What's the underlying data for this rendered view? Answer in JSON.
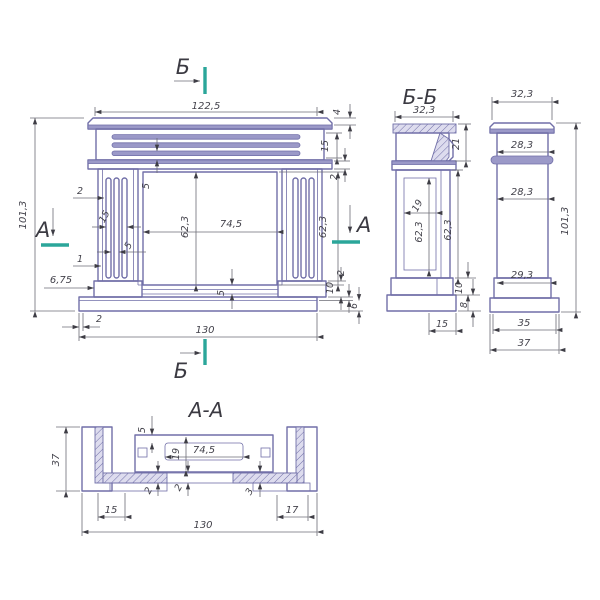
{
  "colors": {
    "line": "#716fa8",
    "dimension": "#6d6d76",
    "text": "#43424b",
    "accent_teal": "#2ba69a",
    "band_fill": "#9b99c8"
  },
  "markers": {
    "a": "А",
    "b": "Б"
  },
  "views": {
    "front": {
      "dims": {
        "width_top": "122,5",
        "height_overall": "101,3",
        "shelf_thickness": "4",
        "frieze_height": "15",
        "band_height": "2",
        "groove_offset": "5",
        "opening_height": "62,3",
        "opening_width": "74,5",
        "opening_height_right": "62,3",
        "flute_width": "2",
        "flute_group_width": "15",
        "flute_gap": "5",
        "groove_width": "1",
        "plinth_offset": "6,75",
        "sill_height": "5",
        "plinth_height": "10",
        "base_step": "2",
        "base_height": "6",
        "base_inset": "2",
        "base_width": "130"
      }
    },
    "section_bb": {
      "title": "Б-Б",
      "dims": {
        "top_width": "32,3",
        "shelf_height": "21",
        "cavity_width": "19",
        "cavity_height": "62,3",
        "body_height": "62,3",
        "plinth_height": "10",
        "base_height": "8",
        "ledge_width": "15"
      }
    },
    "side": {
      "dims": {
        "cap_width": "32,3",
        "neck_width": "28,3",
        "body_width": "28,3",
        "height": "101,3",
        "bottom_width": "29,3",
        "plinth_width": "35",
        "base_width": "37"
      }
    },
    "section_aa": {
      "title": "А-А",
      "dims": {
        "depth": "37",
        "wall_thickness": "5",
        "inner_depth": "19",
        "opening_width": "74,5",
        "gap_left": "2",
        "gap_center": "2",
        "gap_right": "3",
        "left_ledge": "15",
        "right_ledge": "17",
        "overall_width": "130"
      }
    }
  }
}
